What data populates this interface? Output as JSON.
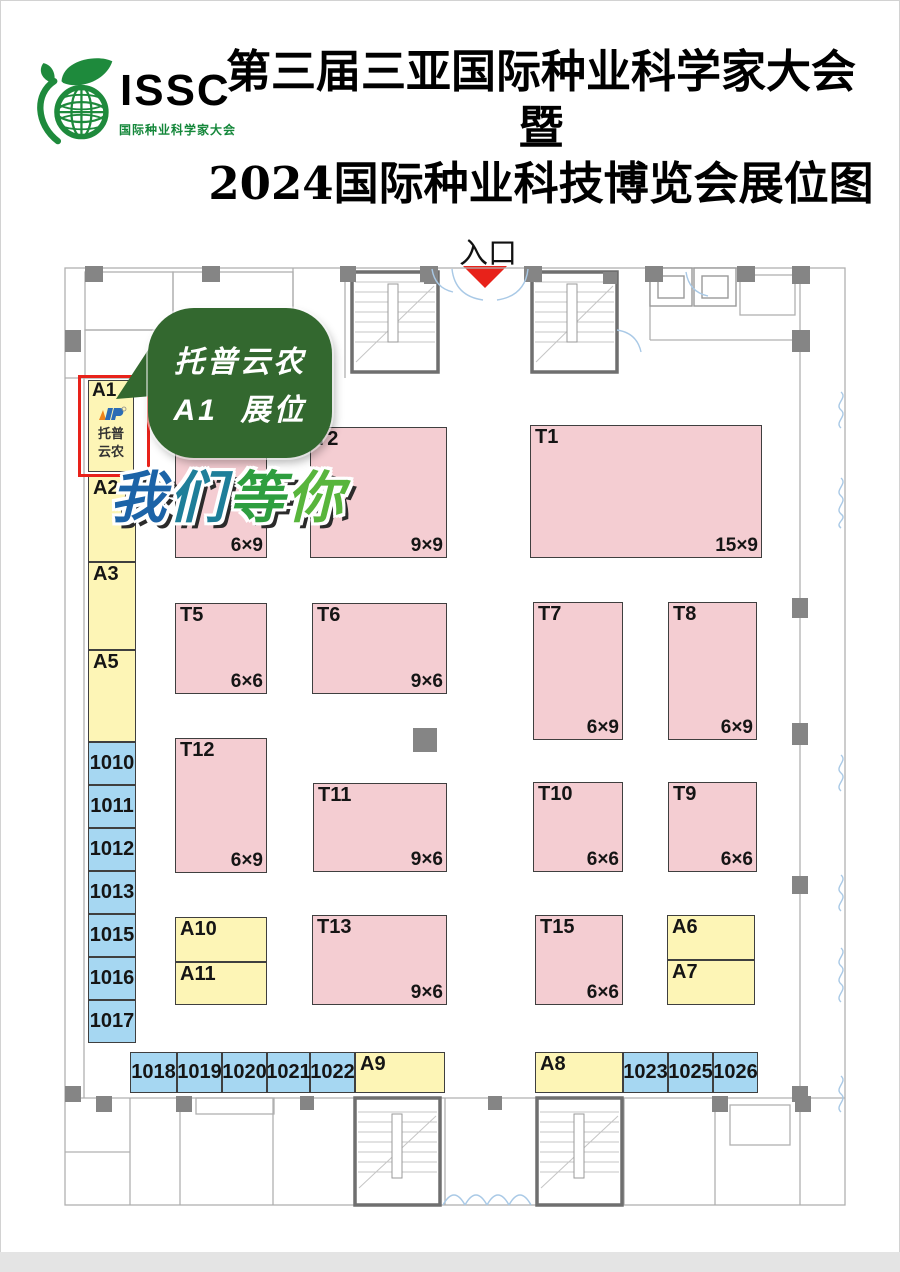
{
  "header": {
    "logo_abbr": "ISSC",
    "logo_subtitle": "国际种业科学家大会",
    "title_line1": "第三届三亚国际种业科学家大会暨",
    "title_line2": "2024国际种业科技博览会展位图"
  },
  "entrance": {
    "label": "入口"
  },
  "callout": {
    "line1": "托普云农",
    "line2": "A1  展位"
  },
  "banner": {
    "text": "我们等你",
    "chars": [
      {
        "ch": "我",
        "color": "#1c63a7"
      },
      {
        "ch": "们",
        "color": "#1e7e99"
      },
      {
        "ch": "等",
        "color": "#2e9e3f"
      },
      {
        "ch": "你",
        "color": "#58b53c"
      }
    ]
  },
  "a1": {
    "id": "A1",
    "company_line1": "托普",
    "company_line2": "云农"
  },
  "palette": {
    "yellow_booth": "#fdf5b6",
    "blue_booth": "#a6d7f2",
    "pink_booth": "#f4cdd2",
    "highlight_red": "#e8221a",
    "bubble_green": "#33682f",
    "logo_green": "#14873a",
    "wall_gray": "#858585"
  },
  "booths": [
    {
      "id": "A2",
      "type": "yellow",
      "x": 88,
      "y": 476,
      "w": 48,
      "h": 86
    },
    {
      "id": "A3",
      "type": "yellow",
      "x": 88,
      "y": 562,
      "w": 48,
      "h": 88
    },
    {
      "id": "A5",
      "type": "yellow",
      "x": 88,
      "y": 650,
      "w": 48,
      "h": 92
    },
    {
      "id": "1010",
      "type": "blue",
      "align": "c",
      "x": 88,
      "y": 742,
      "w": 48,
      "h": 43
    },
    {
      "id": "1011",
      "type": "blue",
      "align": "c",
      "x": 88,
      "y": 785,
      "w": 48,
      "h": 43
    },
    {
      "id": "1012",
      "type": "blue",
      "align": "c",
      "x": 88,
      "y": 828,
      "w": 48,
      "h": 43
    },
    {
      "id": "1013",
      "type": "blue",
      "align": "c",
      "x": 88,
      "y": 871,
      "w": 48,
      "h": 43
    },
    {
      "id": "1015",
      "type": "blue",
      "align": "c",
      "x": 88,
      "y": 914,
      "w": 48,
      "h": 43
    },
    {
      "id": "1016",
      "type": "blue",
      "align": "c",
      "x": 88,
      "y": 957,
      "w": 48,
      "h": 43
    },
    {
      "id": "1017",
      "type": "blue",
      "align": "c",
      "x": 88,
      "y": 1000,
      "w": 48,
      "h": 43
    },
    {
      "id": "1018",
      "type": "blue",
      "align": "c",
      "x": 130,
      "y": 1052,
      "w": 47,
      "h": 41
    },
    {
      "id": "1019",
      "type": "blue",
      "align": "c",
      "x": 177,
      "y": 1052,
      "w": 45,
      "h": 41
    },
    {
      "id": "1020",
      "type": "blue",
      "align": "c",
      "x": 222,
      "y": 1052,
      "w": 45,
      "h": 41
    },
    {
      "id": "1021",
      "type": "blue",
      "align": "c",
      "x": 267,
      "y": 1052,
      "w": 43,
      "h": 41
    },
    {
      "id": "1022",
      "type": "blue",
      "align": "c",
      "x": 310,
      "y": 1052,
      "w": 45,
      "h": 41
    },
    {
      "id": "A9",
      "type": "yellow",
      "x": 355,
      "y": 1052,
      "w": 90,
      "h": 41
    },
    {
      "id": "A8",
      "type": "yellow",
      "x": 535,
      "y": 1052,
      "w": 88,
      "h": 41
    },
    {
      "id": "1023",
      "type": "blue",
      "align": "c",
      "x": 623,
      "y": 1052,
      "w": 45,
      "h": 41
    },
    {
      "id": "1025",
      "type": "blue",
      "align": "c",
      "x": 668,
      "y": 1052,
      "w": 45,
      "h": 41
    },
    {
      "id": "1026",
      "type": "blue",
      "align": "c",
      "x": 713,
      "y": 1052,
      "w": 45,
      "h": 41
    },
    {
      "id": "",
      "type": "pink",
      "x": 175,
      "y": 425,
      "w": 92,
      "h": 133,
      "size": "6×9"
    },
    {
      "id": "T2",
      "type": "pink",
      "x": 310,
      "y": 427,
      "w": 137,
      "h": 131,
      "size": "9×9"
    },
    {
      "id": "T1",
      "type": "pink",
      "x": 530,
      "y": 425,
      "w": 232,
      "h": 133,
      "size": "15×9"
    },
    {
      "id": "T5",
      "type": "pink",
      "x": 175,
      "y": 603,
      "w": 92,
      "h": 91,
      "size": "6×6"
    },
    {
      "id": "T6",
      "type": "pink",
      "x": 312,
      "y": 603,
      "w": 135,
      "h": 91,
      "size": "9×6"
    },
    {
      "id": "T7",
      "type": "pink",
      "x": 533,
      "y": 602,
      "w": 90,
      "h": 138,
      "size": "6×9"
    },
    {
      "id": "T8",
      "type": "pink",
      "x": 668,
      "y": 602,
      "w": 89,
      "h": 138,
      "size": "6×9"
    },
    {
      "id": "T12",
      "type": "pink",
      "x": 175,
      "y": 738,
      "w": 92,
      "h": 135,
      "size": "6×9"
    },
    {
      "id": "T11",
      "type": "pink",
      "x": 313,
      "y": 783,
      "w": 134,
      "h": 89,
      "size": "9×6"
    },
    {
      "id": "T10",
      "type": "pink",
      "x": 533,
      "y": 782,
      "w": 90,
      "h": 90,
      "size": "6×6"
    },
    {
      "id": "T9",
      "type": "pink",
      "x": 668,
      "y": 782,
      "w": 89,
      "h": 90,
      "size": "6×6"
    },
    {
      "id": "A10",
      "type": "yellow",
      "x": 175,
      "y": 917,
      "w": 92,
      "h": 45
    },
    {
      "id": "A11",
      "type": "yellow",
      "x": 175,
      "y": 962,
      "w": 92,
      "h": 43
    },
    {
      "id": "T13",
      "type": "pink",
      "x": 312,
      "y": 915,
      "w": 135,
      "h": 90,
      "size": "9×6"
    },
    {
      "id": "T15",
      "type": "pink",
      "x": 535,
      "y": 915,
      "w": 88,
      "h": 90,
      "size": "6×6"
    },
    {
      "id": "A6",
      "type": "yellow",
      "x": 667,
      "y": 915,
      "w": 88,
      "h": 45
    },
    {
      "id": "A7",
      "type": "yellow",
      "x": 667,
      "y": 960,
      "w": 88,
      "h": 45
    }
  ]
}
